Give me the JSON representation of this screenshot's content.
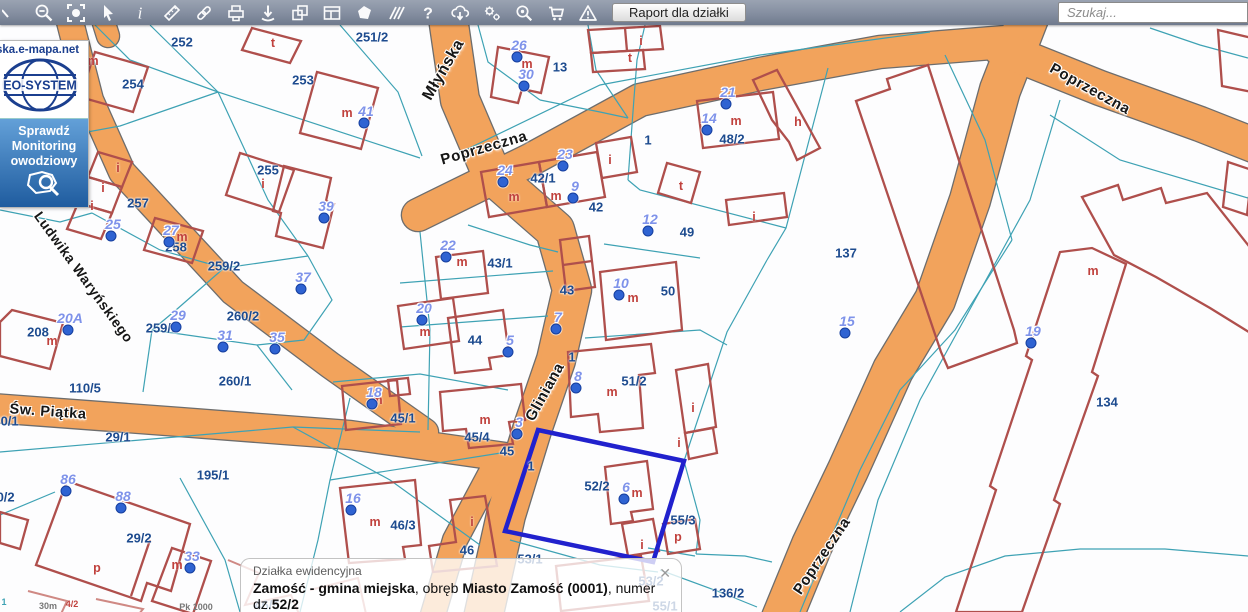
{
  "toolbar": {
    "icons": [
      "zoom-in-partial-icon",
      "zoom-out-icon",
      "full-extent-icon",
      "pointer-icon",
      "info-icon",
      "measure-icon",
      "link-icon",
      "print-icon",
      "download-point-icon",
      "copy-icon",
      "layout-icon",
      "polygon-icon",
      "hatch-icon",
      "help-icon",
      "cloud-download-icon",
      "settings-icon",
      "search-plus-icon",
      "cart-icon",
      "warning-icon"
    ],
    "report_button_label": "Raport dla działki",
    "search_placeholder": "Szukaj..."
  },
  "logo_panel": {
    "site": "ska.e-mapa.net",
    "brand": "EO-SYSTEM",
    "banner_lines": [
      "Sprawdź",
      "Monitoring",
      "owodziowy"
    ]
  },
  "popup": {
    "title": "Działka ewidencyjna",
    "parts": [
      {
        "text": "Zamość - gmina miejska",
        "bold": true
      },
      {
        "text": ", obręb ",
        "bold": false
      },
      {
        "text": "Miasto Zamość (0001)",
        "bold": true
      },
      {
        "text": ", numer dz.",
        "bold": false
      },
      {
        "text": "52/2",
        "bold": true
      }
    ],
    "id_line": "066401_1.0001.AR_52.52/2",
    "close_glyph": "✕"
  },
  "map": {
    "selected_parcel": "52/2",
    "colors": {
      "road_fill": "#F2A35C",
      "road_edge": "#6d6d6d",
      "parcel_line": "#3EA2B4",
      "building": "#AF4F4C",
      "building_faint": "#CF8984",
      "parcel_label": "#1d4b8f",
      "letter": "#c0413d",
      "marker_text": "#7f93ea",
      "marker_dot": "#2f63d2",
      "highlight": "#2121CD"
    },
    "streets": [
      {
        "name": "Młyńska",
        "x": 444,
        "y": 70,
        "angle": -60,
        "size": 16
      },
      {
        "name": "Poprzeczna",
        "x": 484,
        "y": 148,
        "angle": -16,
        "size": 15
      },
      {
        "name": "Poprzeczna",
        "x": 1090,
        "y": 89,
        "angle": 29,
        "size": 15
      },
      {
        "name": "Poprzeczna",
        "x": 822,
        "y": 556,
        "angle": -56,
        "size": 15
      },
      {
        "name": "Gliniana",
        "x": 545,
        "y": 392,
        "angle": -61,
        "size": 15
      },
      {
        "name": "Ludwika Waryńskiego",
        "x": 84,
        "y": 277,
        "angle": 54,
        "size": 14
      },
      {
        "name": "Św. Piątka",
        "x": 48,
        "y": 412,
        "angle": 4,
        "size": 14.5
      }
    ],
    "parcel_labels": [
      {
        "t": "252",
        "x": 182,
        "y": 42
      },
      {
        "t": "251/2",
        "x": 372,
        "y": 37
      },
      {
        "t": "253",
        "x": 303,
        "y": 80
      },
      {
        "t": "254",
        "x": 133,
        "y": 84
      },
      {
        "t": "255",
        "x": 268,
        "y": 170
      },
      {
        "t": "257",
        "x": 138,
        "y": 203
      },
      {
        "t": "258",
        "x": 176,
        "y": 247
      },
      {
        "t": "259/2",
        "x": 224,
        "y": 266
      },
      {
        "t": "259/1",
        "x": 162,
        "y": 328
      },
      {
        "t": "260/2",
        "x": 243,
        "y": 316
      },
      {
        "t": "260/1",
        "x": 235,
        "y": 381
      },
      {
        "t": "110/5",
        "x": 85,
        "y": 388
      },
      {
        "t": "30/1",
        "x": 6,
        "y": 421
      },
      {
        "t": "30/2",
        "x": 2,
        "y": 497
      },
      {
        "t": "29/1",
        "x": 118,
        "y": 437
      },
      {
        "t": "195/1",
        "x": 213,
        "y": 475
      },
      {
        "t": "29/2",
        "x": 139,
        "y": 538
      },
      {
        "t": "13",
        "x": 560,
        "y": 67
      },
      {
        "t": "42/1",
        "x": 543,
        "y": 178
      },
      {
        "t": "42",
        "x": 596,
        "y": 207
      },
      {
        "t": "43/1",
        "x": 500,
        "y": 263
      },
      {
        "t": "43",
        "x": 567,
        "y": 290
      },
      {
        "t": "44",
        "x": 475,
        "y": 340
      },
      {
        "t": "50",
        "x": 668,
        "y": 291
      },
      {
        "t": "49",
        "x": 687,
        "y": 232
      },
      {
        "t": "48/2",
        "x": 732,
        "y": 139
      },
      {
        "t": "51/2",
        "x": 634,
        "y": 381
      },
      {
        "t": "1",
        "x": 648,
        "y": 140
      },
      {
        "t": "1",
        "x": 572,
        "y": 357
      },
      {
        "t": "1",
        "x": 531,
        "y": 466
      },
      {
        "t": "45/1",
        "x": 403,
        "y": 418
      },
      {
        "t": "45/4",
        "x": 477,
        "y": 437
      },
      {
        "t": "45",
        "x": 507,
        "y": 451
      },
      {
        "t": "46/3",
        "x": 403,
        "y": 525
      },
      {
        "t": "46",
        "x": 467,
        "y": 550
      },
      {
        "t": "52/2",
        "x": 597,
        "y": 486
      },
      {
        "t": "55/3",
        "x": 683,
        "y": 520
      },
      {
        "t": "136/2",
        "x": 728,
        "y": 593
      },
      {
        "t": "137",
        "x": 846,
        "y": 253
      },
      {
        "t": "134",
        "x": 1107,
        "y": 402
      },
      {
        "t": "208",
        "x": 38,
        "y": 332
      },
      {
        "t": "53/1",
        "x": 530,
        "y": 559
      },
      {
        "t": "53/2",
        "x": 651,
        "y": 581
      },
      {
        "t": "55/1",
        "x": 665,
        "y": 606
      },
      {
        "t": "46/5",
        "x": 267,
        "y": 605
      }
    ],
    "building_letters": [
      {
        "t": "m",
        "x": 93,
        "y": 61
      },
      {
        "t": "t",
        "x": 273,
        "y": 43
      },
      {
        "t": "i",
        "x": 263,
        "y": 184
      },
      {
        "t": "m",
        "x": 347,
        "y": 113
      },
      {
        "t": "m",
        "x": 527,
        "y": 64
      },
      {
        "t": "i",
        "x": 641,
        "y": 41
      },
      {
        "t": "t",
        "x": 630,
        "y": 58
      },
      {
        "t": "m",
        "x": 736,
        "y": 121
      },
      {
        "t": "h",
        "x": 798,
        "y": 122
      },
      {
        "t": "t",
        "x": 681,
        "y": 186
      },
      {
        "t": "i",
        "x": 754,
        "y": 217
      },
      {
        "t": "m",
        "x": 182,
        "y": 237
      },
      {
        "t": "i",
        "x": 118,
        "y": 168
      },
      {
        "t": "i",
        "x": 103,
        "y": 188
      },
      {
        "t": "i",
        "x": 92,
        "y": 206
      },
      {
        "t": "m",
        "x": 52,
        "y": 341
      },
      {
        "t": "m",
        "x": 514,
        "y": 197
      },
      {
        "t": "m",
        "x": 556,
        "y": 196
      },
      {
        "t": "i",
        "x": 610,
        "y": 160
      },
      {
        "t": "m",
        "x": 462,
        "y": 262
      },
      {
        "t": "m",
        "x": 425,
        "y": 332
      },
      {
        "t": "m",
        "x": 633,
        "y": 298
      },
      {
        "t": "m",
        "x": 612,
        "y": 392
      },
      {
        "t": "i",
        "x": 693,
        "y": 408
      },
      {
        "t": "i",
        "x": 679,
        "y": 443
      },
      {
        "t": "m",
        "x": 377,
        "y": 400
      },
      {
        "t": "m",
        "x": 485,
        "y": 420
      },
      {
        "t": "m",
        "x": 637,
        "y": 493
      },
      {
        "t": "i",
        "x": 642,
        "y": 545
      },
      {
        "t": "p",
        "x": 678,
        "y": 537
      },
      {
        "t": "m",
        "x": 375,
        "y": 522
      },
      {
        "t": "i",
        "x": 472,
        "y": 522
      },
      {
        "t": "p",
        "x": 97,
        "y": 568
      },
      {
        "t": "m",
        "x": 177,
        "y": 565
      },
      {
        "t": "m",
        "x": 1093,
        "y": 271
      }
    ],
    "markers": [
      {
        "n": "41",
        "x": 364,
        "y": 123
      },
      {
        "n": "26",
        "x": 517,
        "y": 57
      },
      {
        "n": "30",
        "x": 524,
        "y": 86
      },
      {
        "n": "21",
        "x": 726,
        "y": 104
      },
      {
        "n": "14",
        "x": 707,
        "y": 130
      },
      {
        "n": "23",
        "x": 563,
        "y": 166
      },
      {
        "n": "24",
        "x": 503,
        "y": 182
      },
      {
        "n": "9",
        "x": 573,
        "y": 198
      },
      {
        "n": "12",
        "x": 648,
        "y": 231
      },
      {
        "n": "39",
        "x": 324,
        "y": 218
      },
      {
        "n": "25",
        "x": 111,
        "y": 236
      },
      {
        "n": "27",
        "x": 169,
        "y": 242
      },
      {
        "n": "22",
        "x": 446,
        "y": 257
      },
      {
        "n": "37",
        "x": 301,
        "y": 289
      },
      {
        "n": "10",
        "x": 619,
        "y": 295
      },
      {
        "n": "20",
        "x": 422,
        "y": 320
      },
      {
        "n": "7",
        "x": 556,
        "y": 329
      },
      {
        "n": "5",
        "x": 508,
        "y": 352
      },
      {
        "n": "29",
        "x": 176,
        "y": 327
      },
      {
        "n": "20A",
        "x": 68,
        "y": 330
      },
      {
        "n": "31",
        "x": 223,
        "y": 347
      },
      {
        "n": "35",
        "x": 275,
        "y": 349
      },
      {
        "n": "15",
        "x": 845,
        "y": 333
      },
      {
        "n": "19",
        "x": 1031,
        "y": 343
      },
      {
        "n": "8",
        "x": 576,
        "y": 388
      },
      {
        "n": "18",
        "x": 372,
        "y": 404
      },
      {
        "n": "3",
        "x": 517,
        "y": 434
      },
      {
        "n": "16",
        "x": 351,
        "y": 510
      },
      {
        "n": "6",
        "x": 624,
        "y": 499
      },
      {
        "n": "86",
        "x": 66,
        "y": 491
      },
      {
        "n": "88",
        "x": 121,
        "y": 508
      },
      {
        "n": "33",
        "x": 190,
        "y": 568
      }
    ],
    "tiny_labels": [
      {
        "t": "30m",
        "x": 48,
        "y": 606,
        "c": "#777777"
      },
      {
        "t": "4/2",
        "x": 72,
        "y": 604,
        "c": "#c0413d"
      },
      {
        "t": "Pk 1000",
        "x": 196,
        "y": 607,
        "c": "#777777"
      },
      {
        "t": "1",
        "x": 4,
        "y": 602,
        "c": "#3EA2B4"
      }
    ]
  }
}
